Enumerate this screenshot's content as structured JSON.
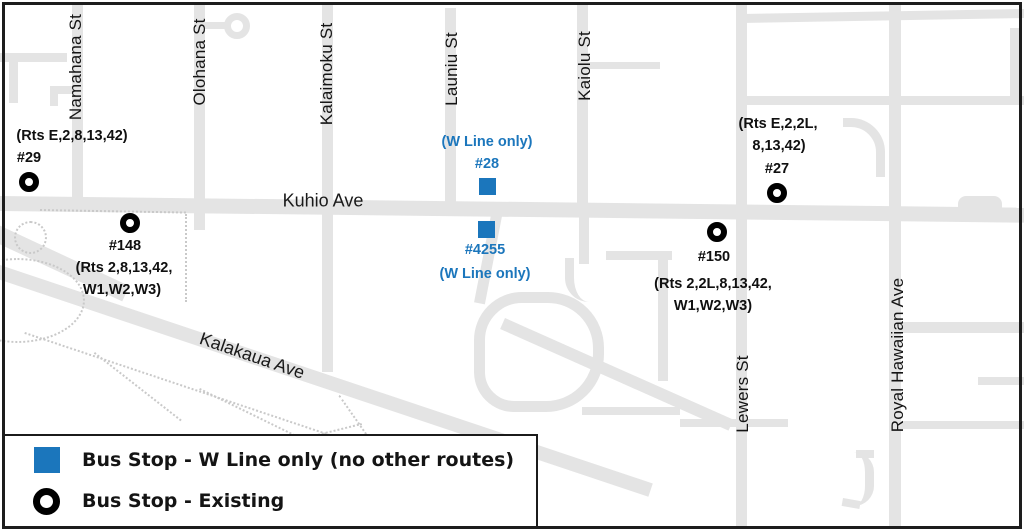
{
  "title": "Waikiki W Line bus stop map",
  "colors": {
    "w_line_blue": "#1b76bc",
    "road_gray": "#e4e4e4",
    "outline_black": "#1d1d1d"
  },
  "streets": {
    "namahana": "Namahana St",
    "olohana": "Olohana St",
    "kalaimoku": "Kalaimoku St",
    "launiu": "Launiu St",
    "kaiolu": "Kaiolu St",
    "lewers": "Lewers St",
    "royal_hawaiian": "Royal Hawaiian Ave",
    "kuhio": "Kuhio Ave",
    "kalakaua": "Kalakaua Ave"
  },
  "stops": {
    "s29": {
      "id": "#29",
      "routes1": "(Rts E,2,8,13,42)"
    },
    "s148": {
      "id": "#148",
      "routes1": "(Rts 2,8,13,42,",
      "routes2": "W1,W2,W3)"
    },
    "s28": {
      "id": "#28",
      "note": "(W Line only)"
    },
    "s4255": {
      "id": "#4255",
      "note": "(W Line only)"
    },
    "s27": {
      "id": "#27",
      "routes1": "(Rts E,2,2L,",
      "routes2": "8,13,42)"
    },
    "s150": {
      "id": "#150",
      "routes1": "(Rts 2,2L,8,13,42,",
      "routes2": "W1,W2,W3)"
    }
  },
  "legend": {
    "w_line": "Bus Stop - W Line only (no other routes)",
    "existing": "Bus Stop - Existing"
  }
}
